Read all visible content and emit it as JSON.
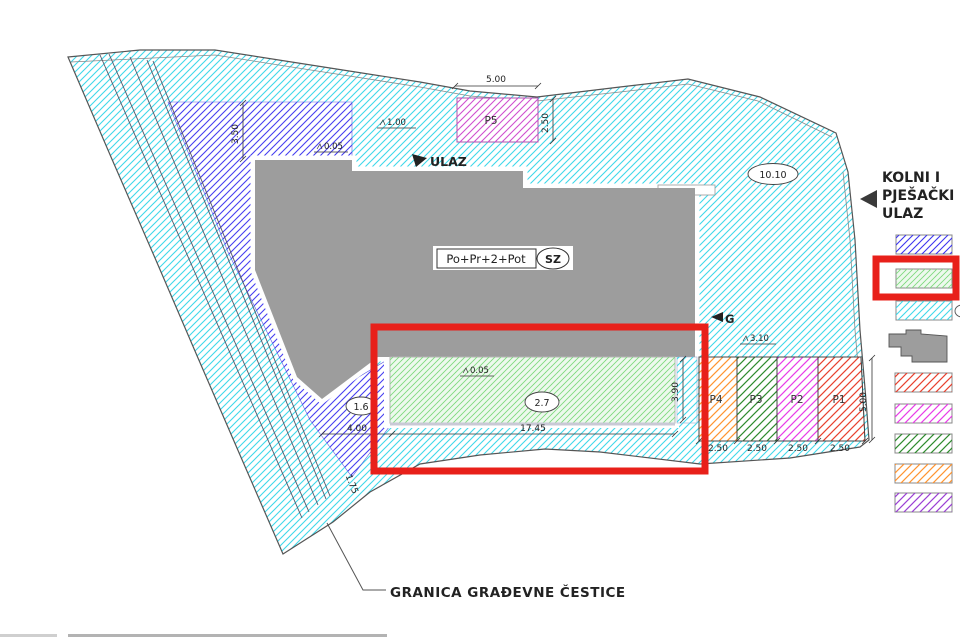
{
  "plan": {
    "building": {
      "label": "Po+Pr+2+Pot",
      "orientation": "SZ"
    },
    "entrances": {
      "ulaz": "ULAZ",
      "garage": "G",
      "kolni_line1": "KOLNI I",
      "kolni_line2": "PJEŠAČKI",
      "kolni_line3": "ULAZ"
    },
    "areas": {
      "p1": "P1",
      "p2": "P2",
      "p3": "P3",
      "p4": "P4",
      "p5": "P5",
      "green_area": "2.7",
      "purple_area": "1.6",
      "site_area": "10.10"
    },
    "dims": {
      "p5_width": "5.00",
      "p5_depth": "2.50",
      "setback_left": "3.50",
      "level_top": "1.00",
      "level_mid": "0.05",
      "level_green": "0.05",
      "level_parking": "3.10",
      "green_depth": "3.90",
      "green_length": "17.45",
      "notch_width": "4.00",
      "diag_width": "1.75",
      "parking_depth": "5.00",
      "stalls": [
        "2.50",
        "2.50",
        "2.50",
        "2.50"
      ]
    },
    "boundary_note": "GRANICA  GRAĐEVNE ČESTICE"
  },
  "legend": {
    "items": [
      {
        "name": "zone-blue-hatch",
        "color": "#3c35f0"
      },
      {
        "name": "zone-green-hatch",
        "color": "#7fd97f",
        "highlighted": true
      },
      {
        "name": "zone-cyan-hatch",
        "color": "#3fd8ea"
      },
      {
        "name": "building-footprint",
        "color": "#9d9d9d"
      },
      {
        "name": "zone-red-hatch",
        "color": "#e8402e"
      },
      {
        "name": "zone-magenta-hatch",
        "color": "#e83ce8"
      },
      {
        "name": "zone-darkgreen-hatch",
        "color": "#2e8b2e"
      },
      {
        "name": "zone-orange-hatch",
        "color": "#ff9430"
      },
      {
        "name": "zone-violet-hatch",
        "color": "#9a3fd4"
      }
    ]
  },
  "colors": {
    "site_hatch": "#3fd8ea",
    "purple_hatch": "#3c35f0",
    "green_area_hatch": "#7fd97f",
    "p5_hatch": "#cf4fcf",
    "building_gray": "#9d9d9d",
    "highlight_red": "#e8201a"
  }
}
